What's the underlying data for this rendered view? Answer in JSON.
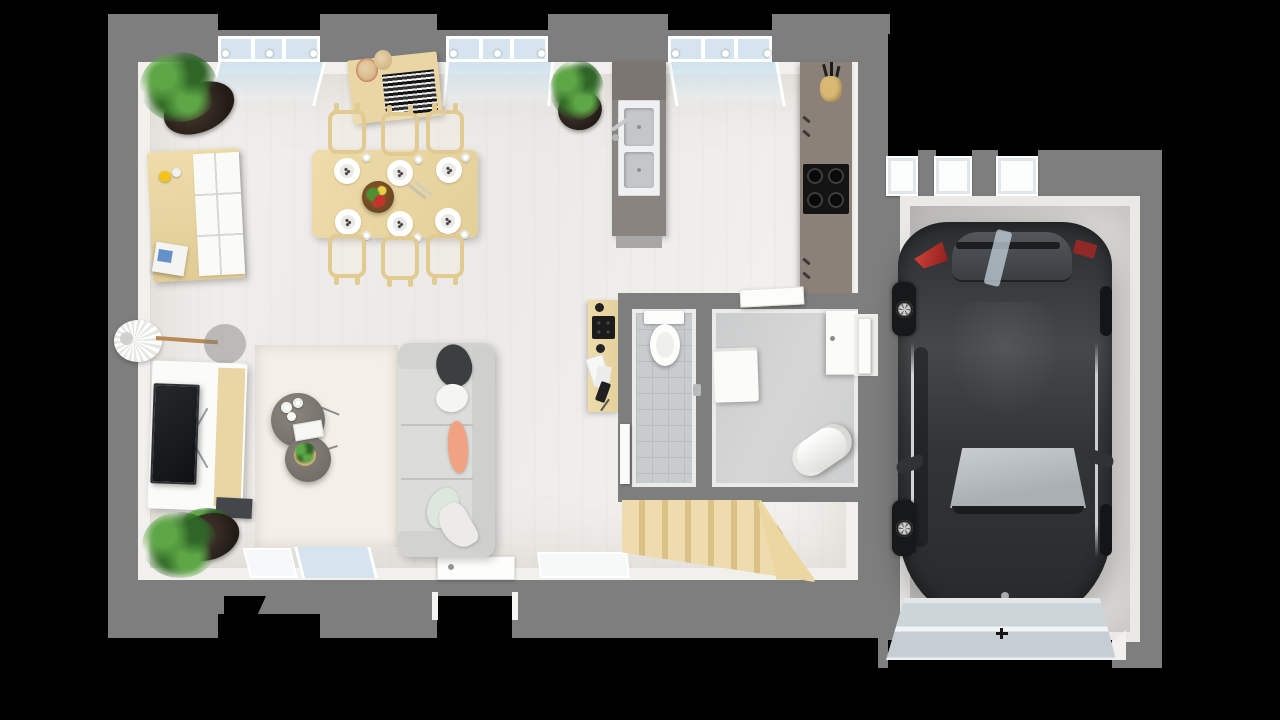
{
  "scene": {
    "description": "Top-down 3D rendered floor plan of a single-storey home with an attached single-car garage on a black background",
    "view": "top-down 3d render",
    "canvas": {
      "width": 1280,
      "height": 720
    },
    "house": {
      "zones": [
        {
          "name": "dining-area",
          "items": [
            "corner-plant",
            "sideboard-with-white-doors",
            "lemon",
            "magazine-stack",
            "wall-shelf-with-jars-and-books",
            "dining-table",
            "fruit-bowl",
            "cutlery"
          ]
        },
        {
          "name": "kitchen",
          "items": [
            "island-with-double-sink-and-faucet",
            "potted-plant",
            "wall-counter",
            "four-burner-cooktop",
            "utensil-pot"
          ]
        },
        {
          "name": "living-area",
          "items": [
            "arc-floor-lamp",
            "tv-cabinet",
            "television",
            "media-box",
            "area-rug",
            "round-coffee-table-large",
            "round-coffee-table-small",
            "vases",
            "white-books",
            "three-seat-sofa",
            "corner-plant"
          ]
        },
        {
          "name": "office-nook",
          "items": [
            "wall-desk",
            "keyboard",
            "papers",
            "phone"
          ]
        },
        {
          "name": "wc",
          "items": [
            "toilet",
            "tiled-floor",
            "door-leaf"
          ]
        },
        {
          "name": "utility-room",
          "items": [
            "washing-machine",
            "water-heater",
            "storage-cabinet",
            "door-leaf"
          ]
        },
        {
          "name": "entry-hall",
          "items": [
            "staircase",
            "front-door"
          ]
        }
      ],
      "window_walls": [
        "top",
        "bottom"
      ]
    },
    "garage": {
      "items": [
        "dark-hatchback-car",
        "sectional-garage-door",
        "small-windows-top-wall",
        "side-door-to-house"
      ],
      "car": {
        "body_color": "#313437",
        "taillight_color": "#c23028",
        "orientation": "rear-at-top"
      }
    }
  },
  "counts": {
    "dining_chairs": 6,
    "place_settings": 6,
    "cooktop_burners": 4,
    "stair_treads": 7,
    "sofa_seats": 3,
    "throw_pillows": 5,
    "indoor_plants": 4,
    "garage_windows": 3,
    "visible_car_wheels": 2
  },
  "colors": {
    "background": "#000000",
    "wall": "#7e7e7e",
    "innerFace": "#f2f0ed",
    "floor": "#efedea",
    "glass": "#d5e4ee",
    "wood": "#e9d6a4",
    "woodDark": "#dcc48d",
    "counter": "#8b8179",
    "island": "#89847f",
    "islandCap": "#7c7673",
    "sinkWhite": "#eef0f1",
    "sinkBasin": "#c3c7c9",
    "cooktop": "#141414",
    "tile": "#c8ccce",
    "concrete": "#cfcfd0",
    "garageFloor": "#d6d4d1",
    "applianceWhite": "#fbfbfa",
    "sofa": "#dcdcda",
    "sofaArm": "#d2d2d0",
    "rug": "#f4f0e9",
    "pillowDark": "#3c3f40",
    "pillowPeach": "#f0a283",
    "pillowMint": "#dce8de",
    "plant": "#3e7a33",
    "plantLight": "#5ea746",
    "pot": "#2b231e",
    "tv": "#17191c",
    "car": "#313437",
    "carGlass": "#bcc2c6",
    "taillight": "#c23028",
    "garageDoor": "#ccd4d7",
    "lemon": "#f2c41d",
    "magazineBlue": "#4a7fc1",
    "chrome": "#b9bcbe"
  }
}
